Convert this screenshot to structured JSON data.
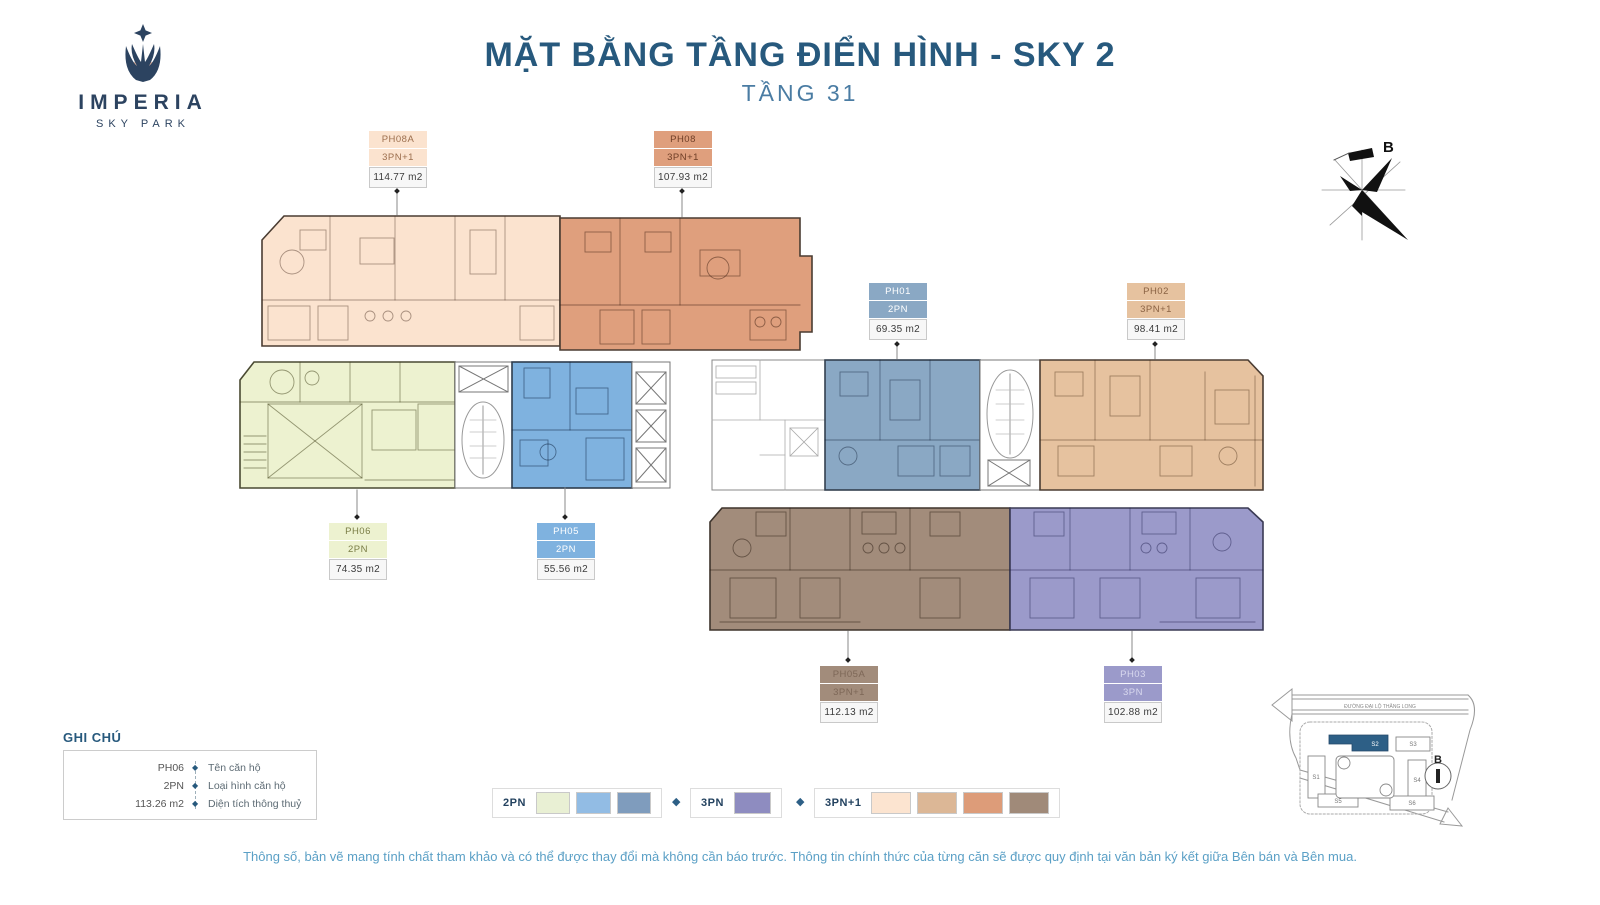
{
  "logo": {
    "name": "IMPERIA",
    "sub": "SKY PARK"
  },
  "header": {
    "title": "MẶT BẰNG TẦNG ĐIỂN HÌNH - SKY 2",
    "subtitle": "TẦNG 31"
  },
  "compass": {
    "label": "B"
  },
  "units": [
    {
      "code": "PH08A",
      "type": "3PN+1",
      "area": "114.77 m2",
      "color": "#fbe3cf",
      "tag_text": "#9c6f4e"
    },
    {
      "code": "PH08",
      "type": "3PN+1",
      "area": "107.93 m2",
      "color": "#df9f7d",
      "tag_text": "#6e3e26"
    },
    {
      "code": "PH01",
      "type": "2PN",
      "area": "69.35 m2",
      "color": "#8aa8c4",
      "tag_text": "#ffffff"
    },
    {
      "code": "PH02",
      "type": "3PN+1",
      "area": "98.41 m2",
      "color": "#e6c29f",
      "tag_text": "#8a6243"
    },
    {
      "code": "PH06",
      "type": "2PN",
      "area": "74.35 m2",
      "color": "#edf2d0",
      "tag_text": "#7a7d46"
    },
    {
      "code": "PH05",
      "type": "2PN",
      "area": "55.56 m2",
      "color": "#7fb2df",
      "tag_text": "#ffffff"
    },
    {
      "code": "PH05A",
      "type": "3PN+1",
      "area": "112.13 m2",
      "color": "#a28c7b",
      "tag_text": "#7d6757"
    },
    {
      "code": "PH03",
      "type": "3PN",
      "area": "102.88 m2",
      "color": "#9b9aca",
      "tag_text": "#d8d8ee"
    }
  ],
  "legend_note": {
    "title": "GHI CHÚ",
    "bullet": "◆",
    "rows": [
      {
        "value": "PH06",
        "desc": "Tên căn hộ"
      },
      {
        "value": "2PN",
        "desc": "Loại hình căn hộ"
      },
      {
        "value": "113.26 m2",
        "desc": "Diện tích thông thuỷ"
      }
    ]
  },
  "type_legend": {
    "separator": "◆",
    "groups": [
      {
        "label": "2PN",
        "colors": [
          "#e9f0d4",
          "#92bce4",
          "#7f9cbd"
        ]
      },
      {
        "label": "3PN",
        "colors": [
          "#8e8cc0"
        ]
      },
      {
        "label": "3PN+1",
        "colors": [
          "#fce4d0",
          "#dcb796",
          "#dd9c79",
          "#a08a79"
        ]
      }
    ]
  },
  "site_map": {
    "road_label": "ĐƯỜNG ĐẠI LỘ THĂNG LONG",
    "highlight": "S2",
    "buildings": [
      "S1",
      "S2",
      "S3",
      "S4",
      "S5",
      "S6"
    ],
    "compass_label": "B"
  },
  "footer": {
    "disclaimer": "Thông số, bản vẽ mang tính chất tham khảo và có thể được thay đổi mà không cần báo trước. Thông tin chính thức của từng căn sẽ được quy định tại văn bản ký kết giữa Bên bán và Bên mua."
  }
}
